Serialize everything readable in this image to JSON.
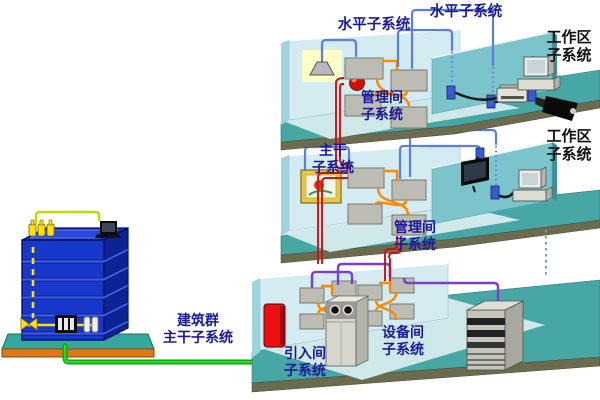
{
  "diagram_title": "综合布线系统结构示意图",
  "labels": {
    "horizontal1": "水平子系统",
    "horizontal2": "水平子系统",
    "workarea_top": "工作区\n子系统",
    "management_top": "管理间\n子系统",
    "workarea_mid": "工作区\n子系统",
    "backbone": "主干\n子系统",
    "management_mid": "管理间\n子系统",
    "campus": "建筑群\n主干子系统",
    "entrance": "引入间\n子系统",
    "equipment": "设备间\n子系统"
  },
  "colors": {
    "slab": "#46a7a4",
    "slab-edge": "#6b6b4f",
    "wall": "#d4ebf2",
    "wall-dark": "#9fd3dc",
    "partition": "#7cc4cb",
    "partition-edge": "#3f8f9a",
    "pale-floor": "#cfe8ea",
    "bld-front": "#1838cc",
    "bld-side": "#0c2396",
    "bld-top": "#16309f",
    "bld-strip": "#3d5ce8",
    "base-teal": "#35a89e",
    "base-orange": "#e07818",
    "cable-blue": "#5b7fe0",
    "cable-red": "#cc1111",
    "cable-green": "#22dd22",
    "cable-green-dk": "#0a9a0a",
    "cable-purple": "#7a3fd0",
    "cable-orange": "#ff8800",
    "cable-yellow": "#ffe400",
    "panel": "#bcbcb4",
    "label-blue": "#1a1a99",
    "label-black": "#101010",
    "redbox": "#ee1010"
  },
  "icons": [
    "building",
    "ceiling-lamp",
    "fire-alarm",
    "patch-panel",
    "wall-outlet",
    "camera",
    "printer",
    "desktop-computer",
    "wall-picture",
    "tv",
    "entrance-protector",
    "pbx-cabinet",
    "server-rack",
    "laptop",
    "ground-terminal"
  ]
}
